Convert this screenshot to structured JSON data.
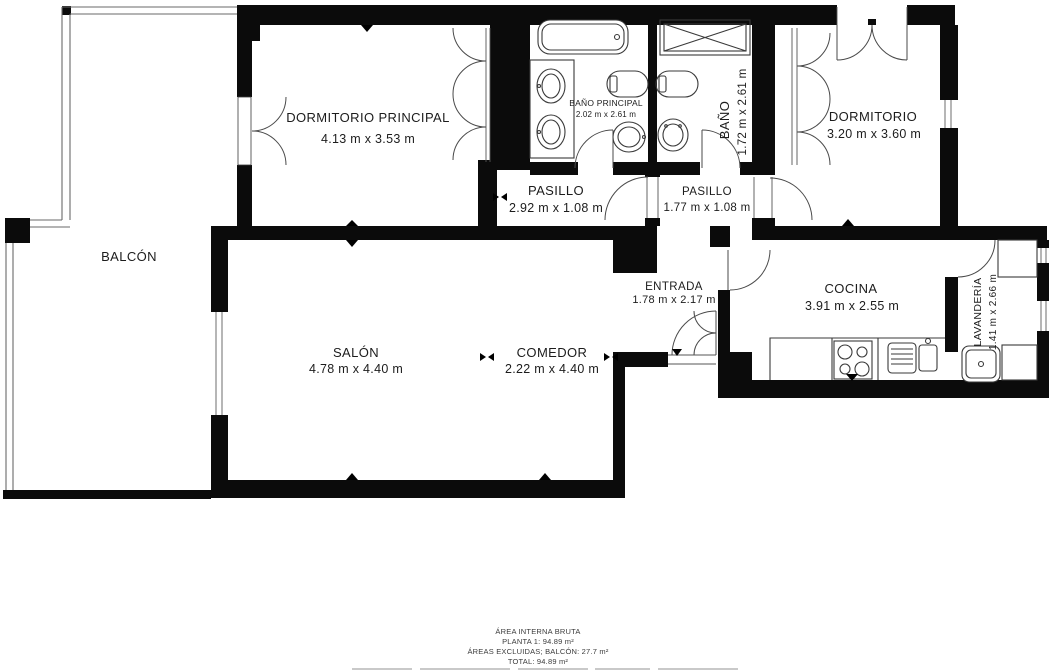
{
  "floorplan": {
    "rooms": {
      "dormitorio_principal": {
        "name": "DORMITORIO PRINCIPAL",
        "dims": "4.13 m x 3.53 m"
      },
      "bano_principal": {
        "name": "BAÑO PRINCIPAL",
        "dims": "2.02 m x 2.61 m"
      },
      "bano": {
        "name": "BAÑO",
        "dims": "1.72 m x 2.61 m"
      },
      "dormitorio": {
        "name": "DORMITORIO",
        "dims": "3.20 m x 3.60 m"
      },
      "pasillo_1": {
        "name": "PASILLO",
        "dims": "2.92 m x 1.08 m"
      },
      "pasillo_2": {
        "name": "PASILLO",
        "dims": "1.77 m x 1.08 m"
      },
      "entrada": {
        "name": "ENTRADA",
        "dims": "1.78 m x 2.17 m"
      },
      "cocina": {
        "name": "COCINA",
        "dims": "3.91 m x 2.55 m"
      },
      "lavanderia": {
        "name": "LAVANDERÍA",
        "dims": "1.41 m x 2.66 m"
      },
      "salon": {
        "name": "SALÓN",
        "dims": "4.78 m x 4.40 m"
      },
      "comedor": {
        "name": "COMEDOR",
        "dims": "2.22 m x 4.40 m"
      },
      "balcon": {
        "name": "BALCÓN",
        "dims": ""
      }
    },
    "summary": {
      "line1": "ÁREA INTERNA BRUTA",
      "line2": "PLANTA 1: 94.89 m²",
      "line3": "ÁREAS EXCLUIDAS; BALCÓN: 27.7 m²",
      "line4": "TOTAL: 94.89 m²"
    },
    "colors": {
      "wall": "#0b0b0b",
      "fixture": "#3a3a3a",
      "background": "#ffffff"
    }
  }
}
